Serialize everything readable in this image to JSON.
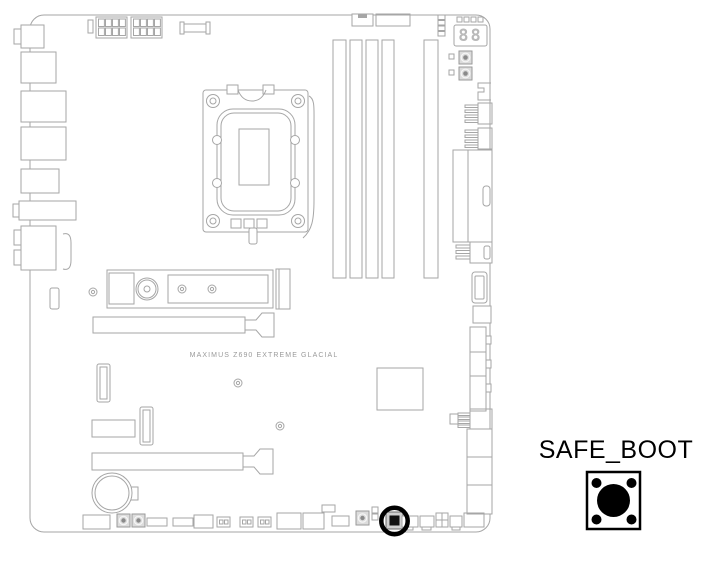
{
  "board": {
    "model_label": "MAXIMUS Z690 EXTREME GLACIAL",
    "qcode": "88"
  },
  "callout": {
    "label": "SAFE_BOOT"
  },
  "colors": {
    "outline_gray": "#a6a6a6",
    "qcode_digit_gray": "#b9b9b9",
    "board_label_gray": "#9a9a9a",
    "callout_black": "#000000",
    "highlight_ring_black": "#000000",
    "button_core_black": "#111111"
  }
}
